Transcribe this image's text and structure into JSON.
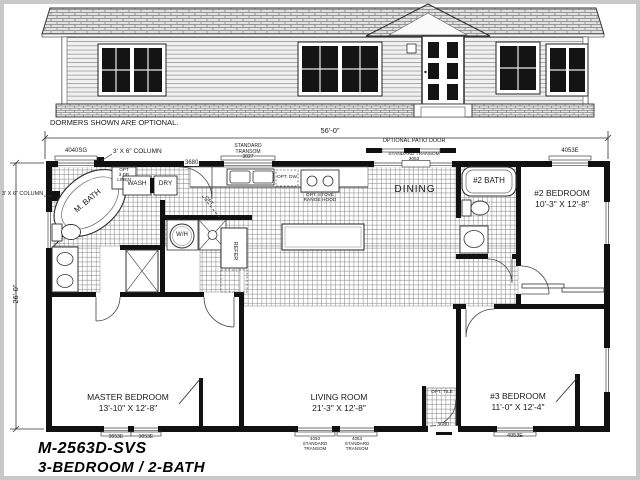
{
  "title": {
    "model": "M-2563D-SVS",
    "subtitle": "3-BEDROOM / 2-BATH"
  },
  "elevation": {
    "caption": "DORMERS SHOWN ARE OPTIONAL."
  },
  "dimensions": {
    "width": "56'-0\"",
    "depth": "26'-0\""
  },
  "rooms": {
    "master_bath": "M. BATH",
    "dining": "DINING",
    "bath2": "#2 BATH",
    "bedroom2": "#2 BEDROOM\n10'-3\" X 12'-8\"",
    "bedroom3": "#3 BEDROOM\n11'-0\" X 12'-4\"",
    "master_bedroom": "MASTER BEDROOM\n13'-10\" X 12'-8\"",
    "living_room": "LIVING ROOM\n21'-3\" X 12'-8\""
  },
  "annotations": {
    "column_top": "3' X 6\" COLUMN",
    "column_left": "3' X 6\" COLUMN",
    "opt_linen": "OPT\n3 DR\nLINEN",
    "wash": "WASH",
    "dry": "DRY",
    "water_heater": "W/H",
    "refrigerator": "REFER",
    "opt_dw": "OPT. DW",
    "opt_stove": "OPT. STOVE\nRANGE HOOD",
    "opt_door": "OPT.",
    "opt_tile": "OPT. TILE",
    "patio_door": "OPTIONAL PATIO DOOR",
    "patio_transom": "STANDARD TRANSOM\n3053"
  },
  "openings": {
    "window_4040sg": "4040SG",
    "transom_3027": "STANDARD\nTRANSOM\n3027",
    "window_4053e_top": "4053E",
    "door_back": "3680",
    "door_front": "3680",
    "window_3053e_a": "3053E",
    "window_3053e_b": "3053E",
    "transom_4053_a": "4053\nSTANDARD\nTRANSOM",
    "transom_4053_b": "4053\nSTANDARD\nTRANSOM",
    "window_4053e_bottom": "4053E"
  }
}
